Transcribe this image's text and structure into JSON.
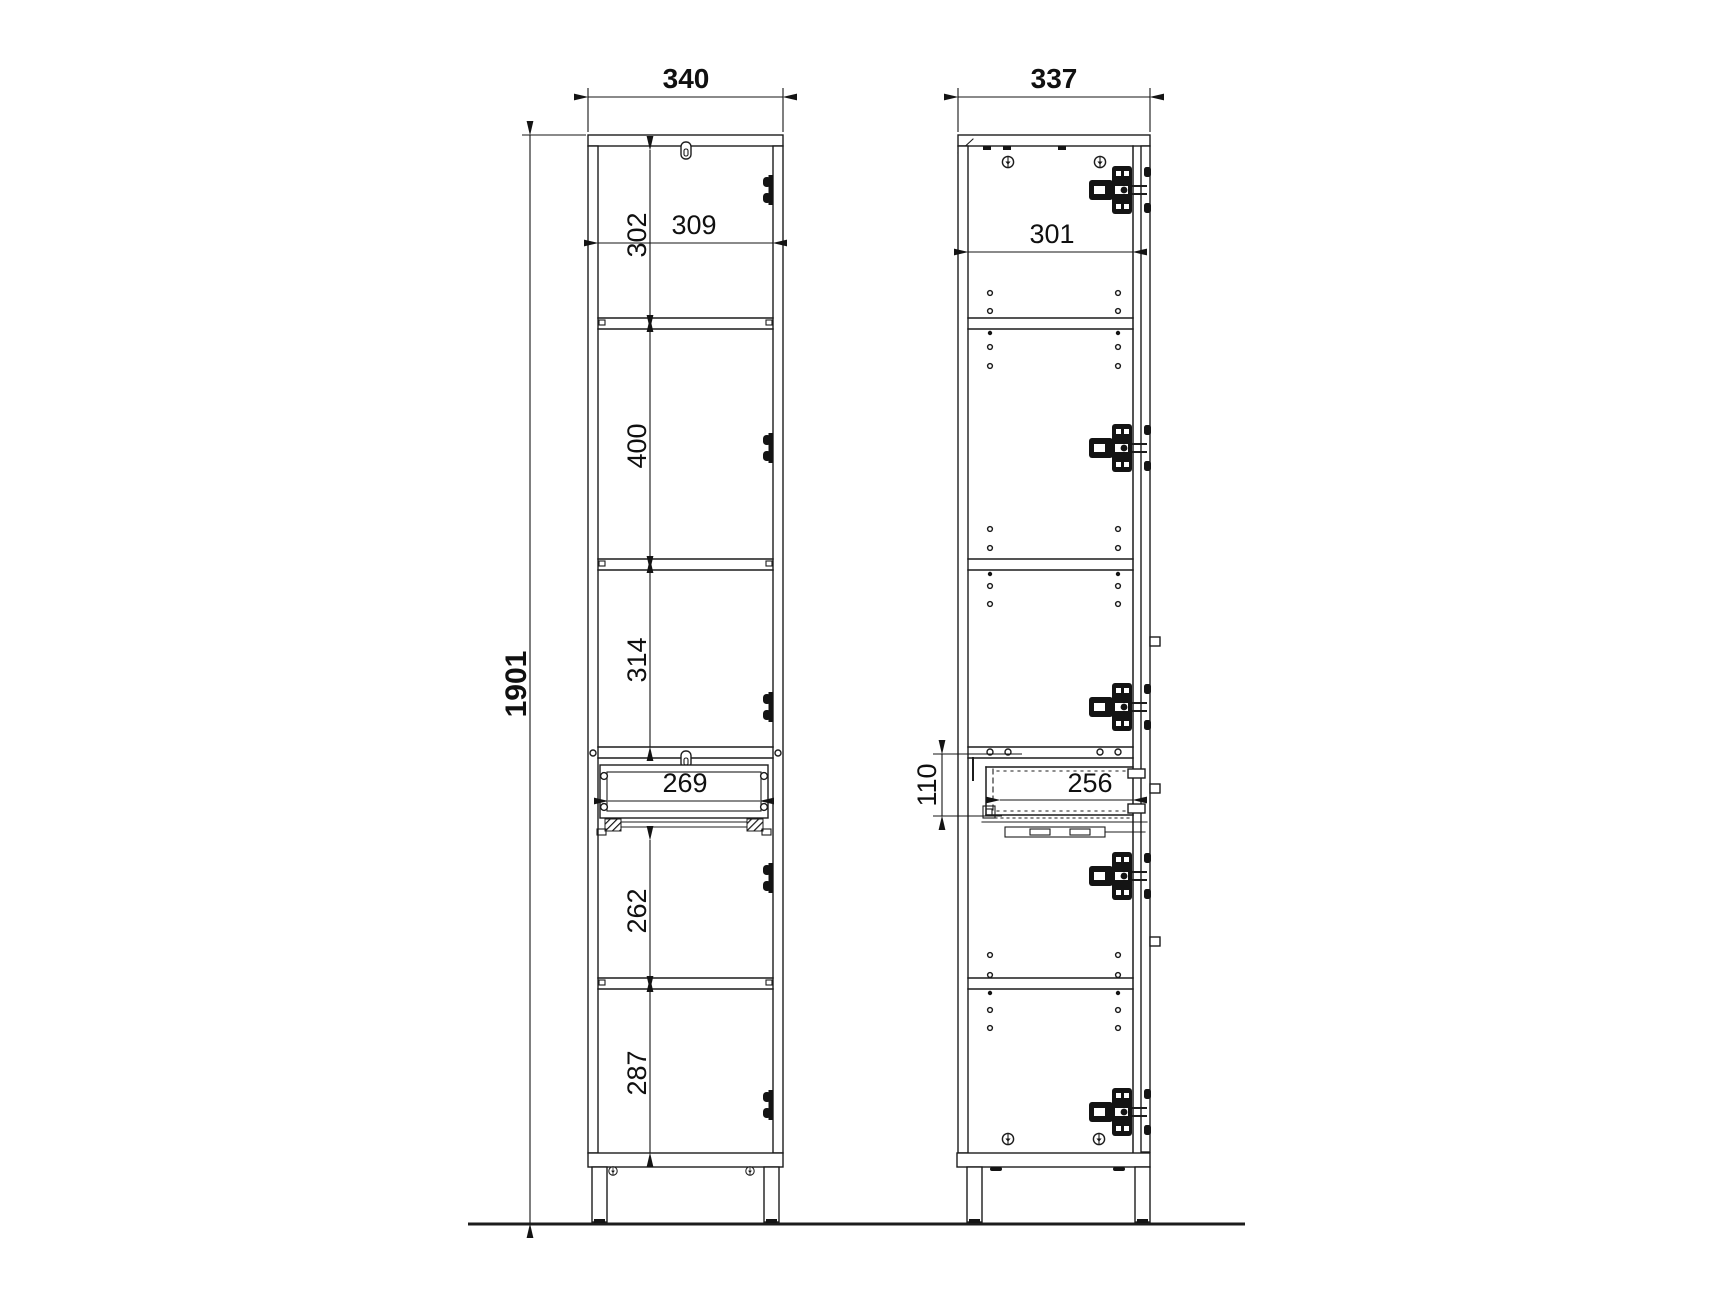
{
  "drawing": {
    "type": "furniture cabinet dimension drawing, front and side views",
    "front_view": {
      "overall_width": "340",
      "overall_height": "1901",
      "shelf_opening_width": "309",
      "top_compartment_height": "302",
      "second_compartment_height": "400",
      "third_compartment_height": "314",
      "drawer_opening_width": "269",
      "fourth_compartment_height": "262",
      "bottom_compartment_height": "287"
    },
    "side_view": {
      "overall_depth": "337",
      "interior_depth": "301",
      "drawer_height": "110",
      "drawer_depth": "256"
    },
    "colors": {
      "line": "#1c1c1c",
      "hardware": "#141414",
      "background": "#ffffff"
    }
  }
}
